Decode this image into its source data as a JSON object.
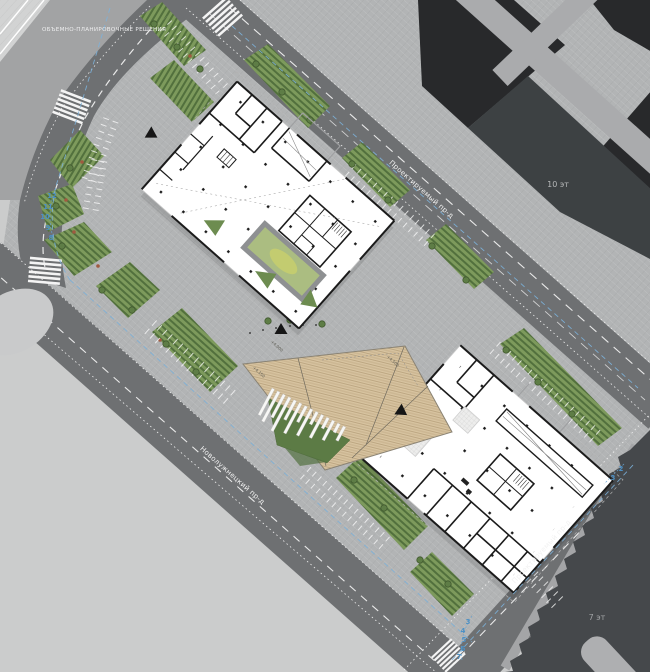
{
  "title": "ОБЪЕМНО-ПЛАНИРОВОЧНЫЕ РЕШЕНИЯ",
  "roads": {
    "top_label": "Проектируемый пр-д",
    "west_label": "Новолужнецкий пр-д",
    "southeast_label": "Проектируемый пр-д"
  },
  "buildings": {
    "northeast_tower_floors": "10 эт",
    "southeast_tower_floors": "7 эт"
  },
  "deck": {
    "elevation_north": "+4.000",
    "elevation_west": "+4.150",
    "elevation_east": "+4.500"
  },
  "axes": {
    "west": [
      "12",
      "11",
      "10",
      "9",
      "8"
    ],
    "east": [
      "2",
      "3"
    ],
    "south": [
      "3",
      "4",
      "5",
      "6",
      "7"
    ]
  },
  "colors": {
    "background": "#cbcccc",
    "plaza": "#b2b4b5",
    "road": "#6e7072",
    "dark_building": "#28292b",
    "mid_building": "#3d4143",
    "tower7": "#45484b",
    "green_strip": "#7d9a5c",
    "lawn": "#5c7b45",
    "deck_wood": "#d8c4a1",
    "axis_blue": "#4d90c4",
    "plan_wall": "#1b1b1b"
  }
}
